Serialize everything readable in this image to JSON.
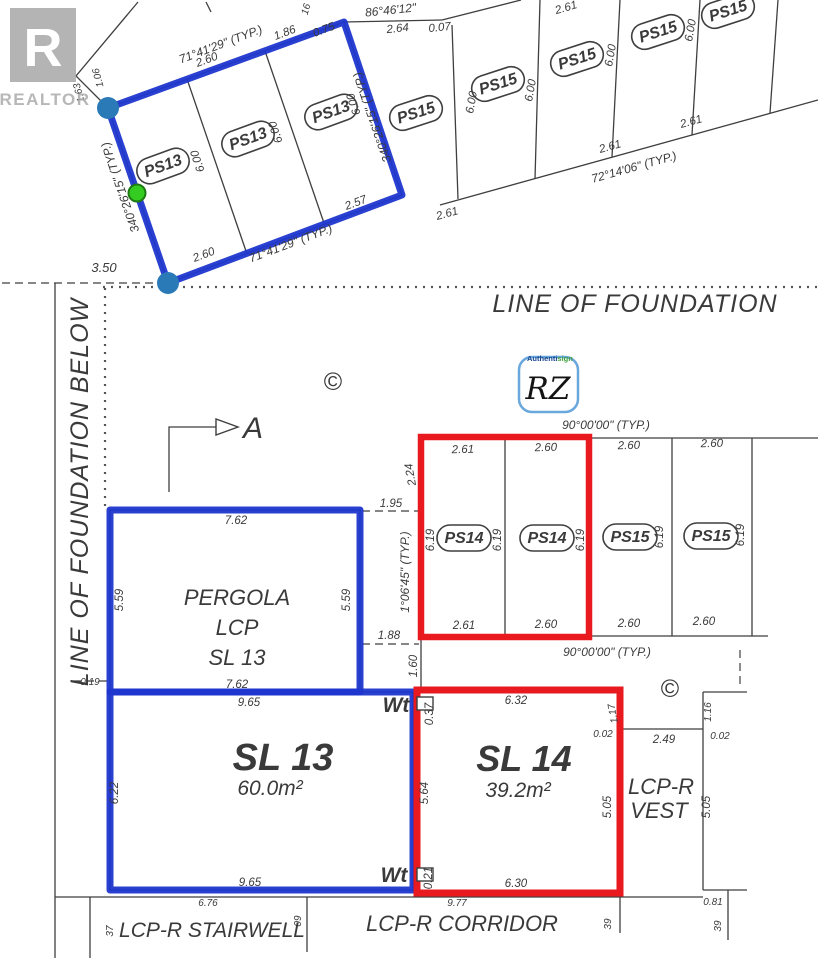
{
  "watermark": {
    "logo_letter": "R",
    "label": "REALTOR"
  },
  "stamp": {
    "brand_authenti": "Authenti",
    "brand_sign": "sign",
    "initials": "RZ"
  },
  "foundation": {
    "line_label": "LINE OF FOUNDATION",
    "below_label": "LINE OF FOUNDATION BELOW",
    "offset_dim": "3.50"
  },
  "section_marker": {
    "label": "A"
  },
  "copyright_top": "©",
  "copyright_right": "©",
  "ps13_block": {
    "stalls": [
      "PS13",
      "PS13",
      "PS13"
    ],
    "depth_dims": [
      "6.00",
      "6.00",
      "6.00"
    ],
    "top_angle": "71°41'29\" (TYP.)",
    "top_dims": [
      "2.60",
      "1.86",
      "0.75"
    ],
    "corner_dims": [
      "1.63",
      "1.06"
    ],
    "edge_dim": "16",
    "left_angle": "340°26'15\" (TYP.)",
    "right_angle": "340°26'15\" (TYP.)",
    "bottom_dims": [
      "2.60",
      "2.57"
    ],
    "bottom_angle": "71°41'29\" (TYP.)"
  },
  "ps15_block": {
    "stalls": [
      "PS15",
      "PS15",
      "PS15",
      "PS15",
      "PS15"
    ],
    "depth_dims": [
      "6.00",
      "6.00",
      "6.00",
      "6.00"
    ],
    "top_bearing": "86°46'12\"",
    "top_dims": [
      "2.64",
      "0.07",
      "2.61"
    ],
    "bottom_dims": [
      "2.61",
      "2.61",
      "2.61"
    ],
    "bottom_angle": "72°14'06\" (TYP.)"
  },
  "parking_row": {
    "top_angle": "90°00'00\" (TYP.)",
    "top_dims": [
      "2.61",
      "2.60",
      "2.60",
      "2.60"
    ],
    "stalls": [
      "PS14",
      "PS14",
      "PS15",
      "PS15"
    ],
    "depth_dims": [
      "6.19",
      "6.19",
      "6.19",
      "6.19",
      "6.19"
    ],
    "bottom_dims": [
      "2.61",
      "2.60",
      "2.60",
      "2.60"
    ],
    "bottom_angle": "90°00'00\" (TYP.)",
    "left_dims": {
      "seg_top": "2.24",
      "gap_top": "1.95",
      "angle": "1°06'45\" (TYP.)",
      "gap_bottom": "1.88",
      "seg_bottom": "1.60"
    }
  },
  "pergola": {
    "title": "PERGOLA",
    "subtitle": "LCP",
    "lot": "SL 13",
    "top_dim": "7.62",
    "left_dim": "5.59",
    "right_dim": "5.59",
    "bottom_dim": "7.62",
    "offset_dim": "0.19"
  },
  "sl13": {
    "title": "SL 13",
    "area": "60.0m²",
    "top_dim": "9.65",
    "left_dim": "6.22",
    "bottom_dim": "9.65",
    "below_dim": "6.76"
  },
  "sl14": {
    "title": "SL 14",
    "area": "39.2m²",
    "top_dim": "6.32",
    "bottom_dim": "6.30",
    "left_dim": "5.64",
    "right_dim": "5.05",
    "window_top": "0.37",
    "window_bottom": "0.21",
    "jog_dim": "1.17",
    "gap_dim": "0.02",
    "below_dim": "9.77"
  },
  "vest": {
    "line1": "LCP-R",
    "line2": "VEST",
    "link_dim": "2.49",
    "top_dim": "1.16",
    "gap_dim": "0.02",
    "right_dim": "5.05",
    "bottom_dim": "0.81",
    "below_dim": "39"
  },
  "corridor": {
    "label": "LCP-R CORRIDOR",
    "right_dim": "39"
  },
  "stairwell": {
    "label": "LCP-R STAIRWELL",
    "left_dim": "37",
    "right_dim": "09"
  },
  "wt": {
    "top": "Wt",
    "bottom": "Wt"
  }
}
